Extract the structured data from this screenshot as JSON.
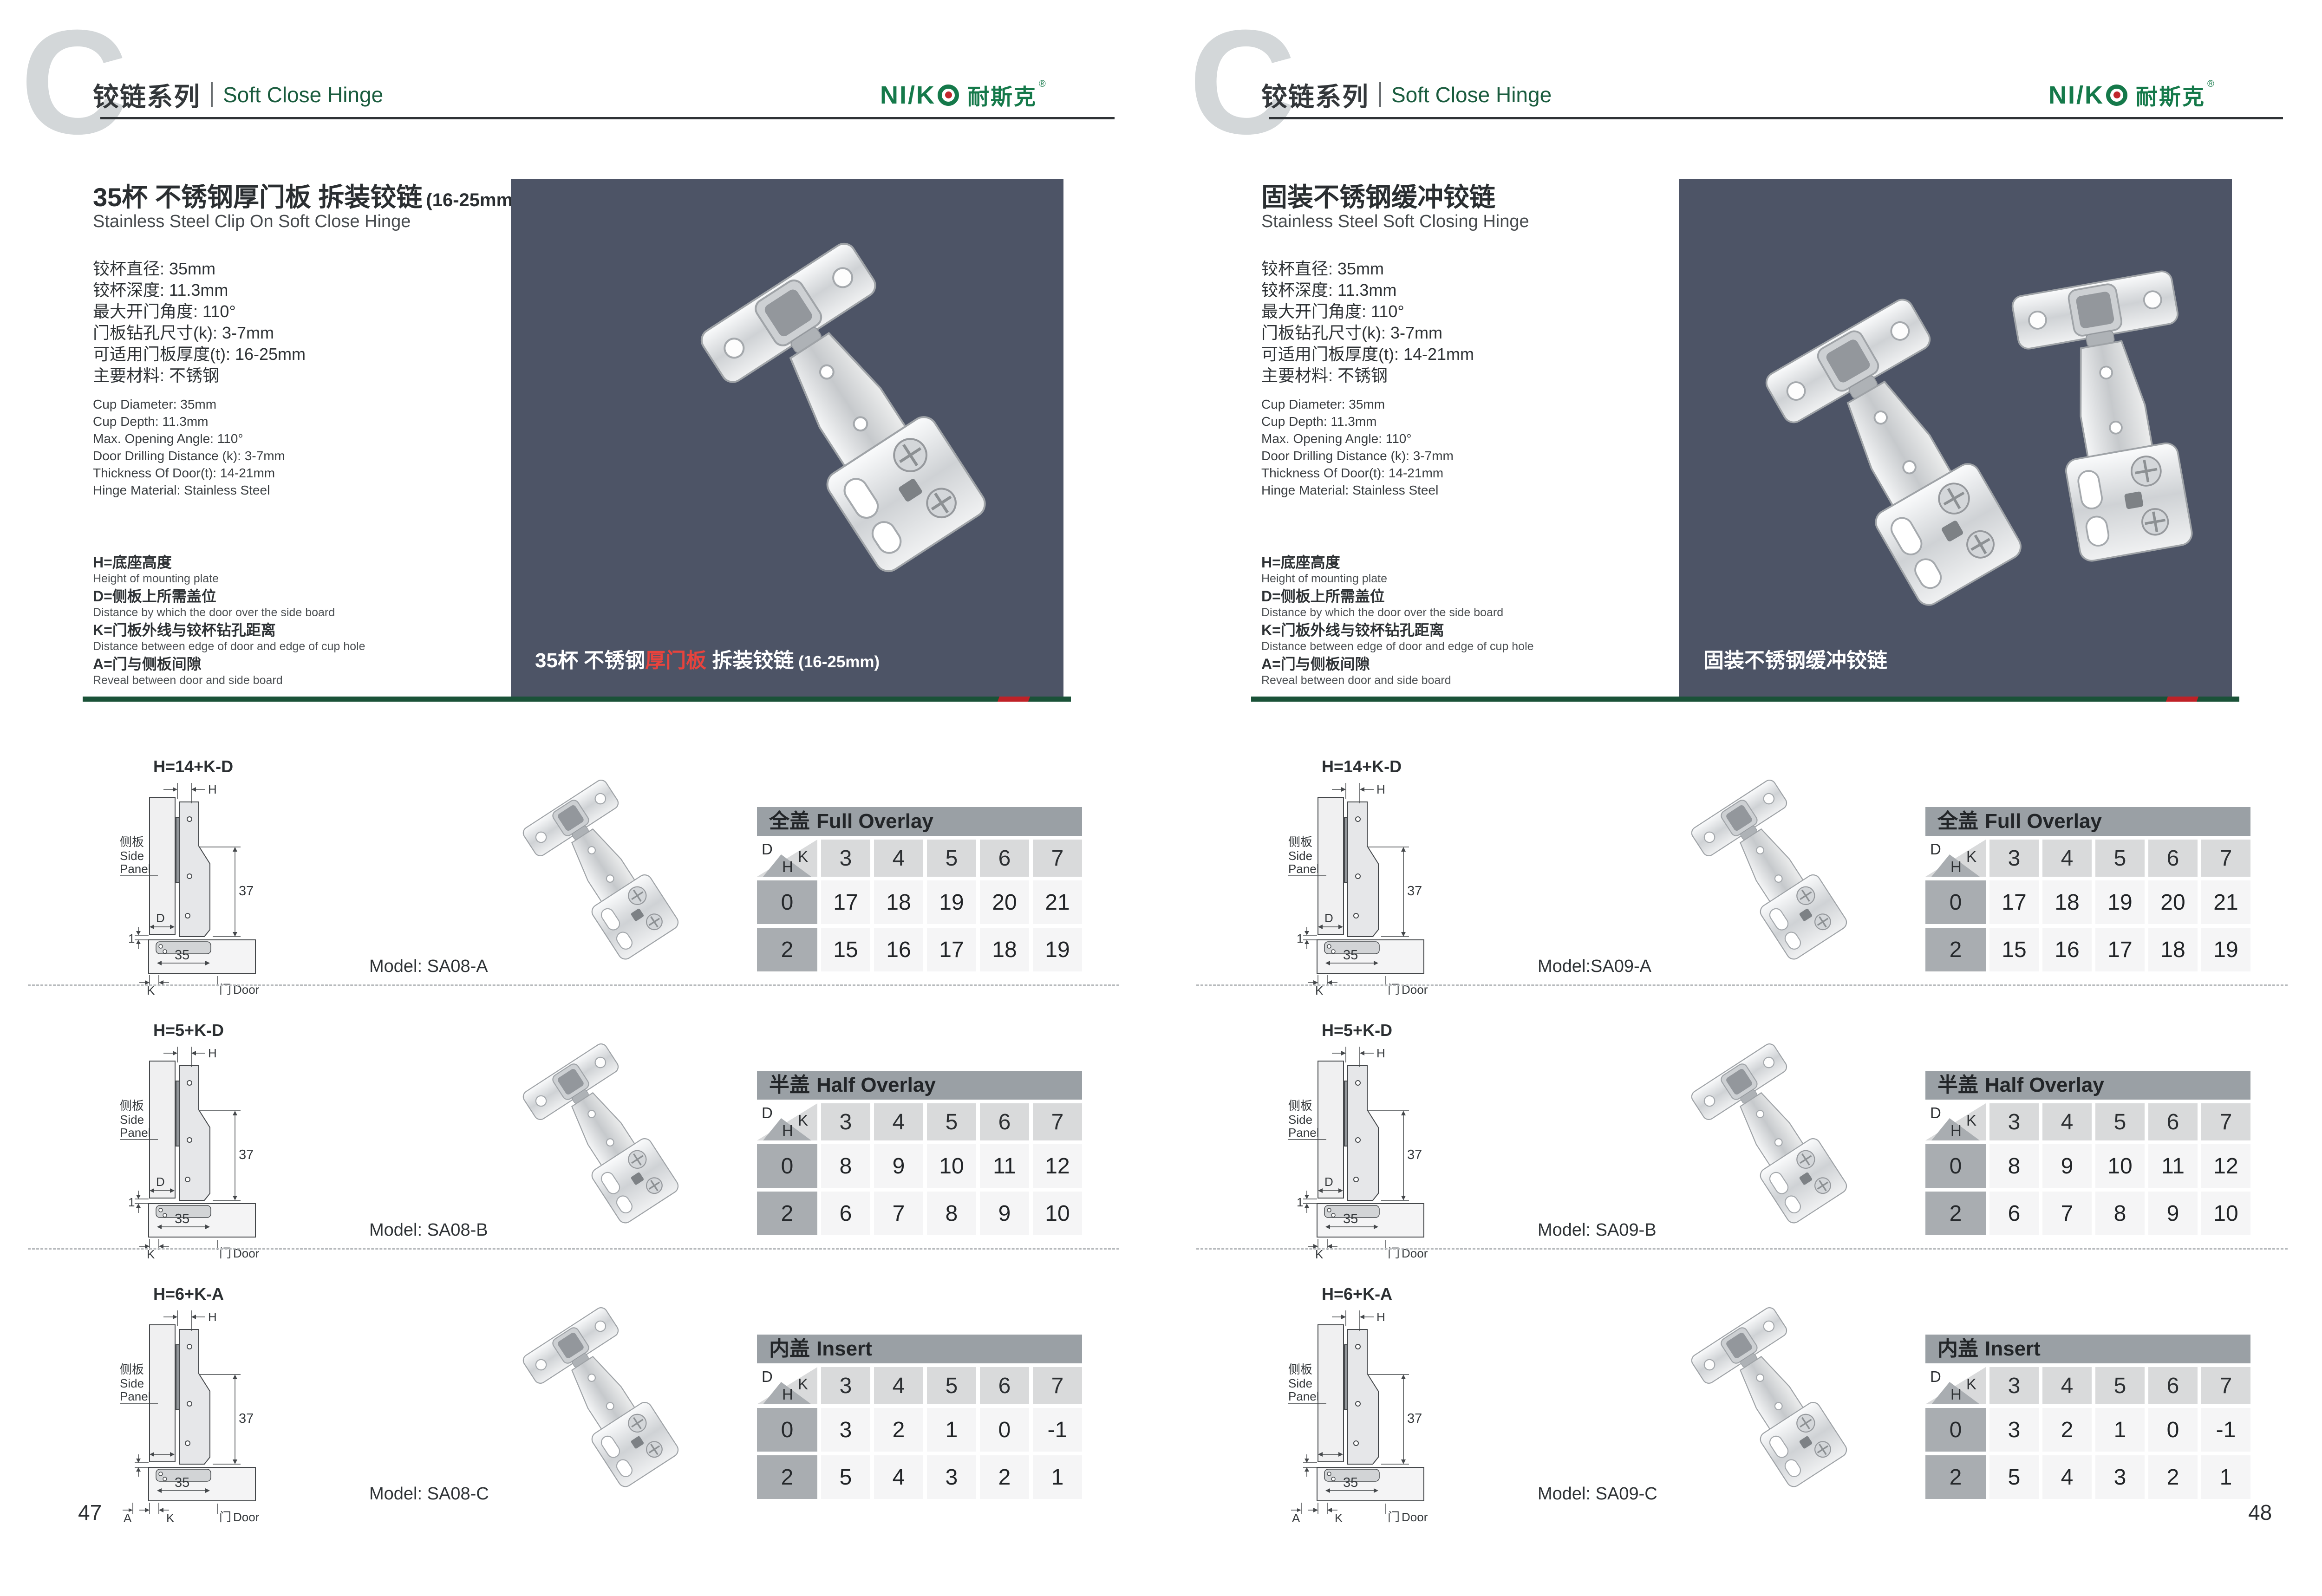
{
  "shared": {
    "header": {
      "watermark": "C",
      "series_cn": "铰链系列",
      "series_en": "Soft Close Hinge"
    },
    "logo": {
      "latin": "NI/K",
      "cn": "耐斯克",
      "reg": "®"
    },
    "corner": {
      "d": "D",
      "k": "K",
      "h": "H"
    },
    "diagram": {
      "h": "H",
      "d": "D",
      "k": "K",
      "a": "A",
      "gap": "1",
      "cup_width": "35",
      "plate_height": "37",
      "side_panel_cn": "侧板",
      "side_panel_en_1": "Side",
      "side_panel_en_2": "Panel",
      "door_cn": "门",
      "door_en": "Door"
    }
  },
  "colors": {
    "brand_green": "#15794a",
    "heading_green": "#1a5c3e",
    "accent_red": "#c1272d",
    "divider_green": "#1a5238",
    "divider_red": "#bf2127",
    "photo_background": "#4d5466",
    "table_title_bar": "#9aa0a5",
    "table_header_cell": "#d9dadb",
    "table_row_label": "#a9adb1",
    "table_value_cell": "#f5f5f6",
    "watermark_gray": "#d3d7d9",
    "caption_red": "#e8433d"
  },
  "pages": [
    {
      "page_number": "47",
      "product": {
        "title_cn": "35杯 不锈钢厚门板 拆装铰链",
        "title_suffix": "(16-25mm)",
        "subtitle_en": "Stainless Steel Clip On Soft Close Hinge",
        "specs_cn": [
          "铰杯直径: 35mm",
          "铰杯深度: 11.3mm",
          "最大开门角度: 110°",
          "门板钻孔尺寸(k): 3-7mm",
          "可适用门板厚度(t): 16-25mm",
          "主要材料: 不锈钢"
        ],
        "specs_en": [
          "Cup Diameter: 35mm",
          "Cup Depth: 11.3mm",
          "Max. Opening Angle: 110°",
          "Door Drilling Distance (k): 3-7mm",
          "Thickness Of Door(t): 14-21mm",
          "Hinge Material: Stainless Steel"
        ],
        "definitions": [
          {
            "cn": "H=底座高度",
            "en": "Height of mounting plate"
          },
          {
            "cn": "D=侧板上所需盖位",
            "en": "Distance by which the door over the side board"
          },
          {
            "cn": "K=门板外线与铰杯钻孔距离",
            "en": "Distance between edge of door and edge of cup hole"
          },
          {
            "cn": "A=门与侧板间隙",
            "en": "Reveal between door and side board"
          }
        ],
        "photo_caption": {
          "pre": "35杯 不锈钢",
          "red": "厚门板",
          "post": " 拆装铰链",
          "suffix": " (16-25mm)"
        }
      },
      "sections": [
        {
          "formula": "H=14+K-D",
          "model": "Model: SA08-A",
          "table": {
            "title_cn": "全盖",
            "title_en": "Full Overlay",
            "k_values": [
              "3",
              "4",
              "5",
              "6",
              "7"
            ],
            "rows": [
              {
                "h": "0",
                "values": [
                  "17",
                  "18",
                  "19",
                  "20",
                  "21"
                ]
              },
              {
                "h": "2",
                "values": [
                  "15",
                  "16",
                  "17",
                  "18",
                  "19"
                ]
              }
            ]
          }
        },
        {
          "formula": "H=5+K-D",
          "model": "Model: SA08-B",
          "table": {
            "title_cn": "半盖",
            "title_en": "Half Overlay",
            "k_values": [
              "3",
              "4",
              "5",
              "6",
              "7"
            ],
            "rows": [
              {
                "h": "0",
                "values": [
                  "8",
                  "9",
                  "10",
                  "11",
                  "12"
                ]
              },
              {
                "h": "2",
                "values": [
                  "6",
                  "7",
                  "8",
                  "9",
                  "10"
                ]
              }
            ]
          }
        },
        {
          "formula": "H=6+K-A",
          "model": "Model: SA08-C",
          "table": {
            "title_cn": "内盖",
            "title_en": "Insert",
            "k_values": [
              "3",
              "4",
              "5",
              "6",
              "7"
            ],
            "rows": [
              {
                "h": "0",
                "values": [
                  "3",
                  "2",
                  "1",
                  "0",
                  "-1"
                ]
              },
              {
                "h": "2",
                "values": [
                  "5",
                  "4",
                  "3",
                  "2",
                  "1"
                ]
              }
            ]
          }
        }
      ]
    },
    {
      "page_number": "48",
      "product": {
        "title_cn": "固装不锈钢缓冲铰链",
        "title_suffix": "",
        "subtitle_en": "Stainless Steel Soft Closing Hinge",
        "specs_cn": [
          "铰杯直径: 35mm",
          "铰杯深度: 11.3mm",
          "最大开门角度: 110°",
          "门板钻孔尺寸(k): 3-7mm",
          "可适用门板厚度(t): 14-21mm",
          "主要材料: 不锈钢"
        ],
        "specs_en": [
          "Cup Diameter: 35mm",
          "Cup Depth: 11.3mm",
          "Max. Opening Angle: 110°",
          "Door Drilling Distance (k): 3-7mm",
          "Thickness Of Door(t): 14-21mm",
          "Hinge Material: Stainless Steel"
        ],
        "definitions": [
          {
            "cn": "H=底座高度",
            "en": "Height of mounting plate"
          },
          {
            "cn": "D=侧板上所需盖位",
            "en": "Distance by which the door over the side board"
          },
          {
            "cn": "K=门板外线与铰杯钻孔距离",
            "en": "Distance between edge of door and edge of cup hole"
          },
          {
            "cn": "A=门与侧板间隙",
            "en": "Reveal between door and side board"
          }
        ],
        "photo_caption": {
          "pre": "固装不锈钢缓冲铰链",
          "red": "",
          "post": "",
          "suffix": ""
        }
      },
      "sections": [
        {
          "formula": "H=14+K-D",
          "model": "Model:SA09-A",
          "table": {
            "title_cn": "全盖",
            "title_en": "Full Overlay",
            "k_values": [
              "3",
              "4",
              "5",
              "6",
              "7"
            ],
            "rows": [
              {
                "h": "0",
                "values": [
                  "17",
                  "18",
                  "19",
                  "20",
                  "21"
                ]
              },
              {
                "h": "2",
                "values": [
                  "15",
                  "16",
                  "17",
                  "18",
                  "19"
                ]
              }
            ]
          }
        },
        {
          "formula": "H=5+K-D",
          "model": "Model: SA09-B",
          "table": {
            "title_cn": "半盖",
            "title_en": "Half Overlay",
            "k_values": [
              "3",
              "4",
              "5",
              "6",
              "7"
            ],
            "rows": [
              {
                "h": "0",
                "values": [
                  "8",
                  "9",
                  "10",
                  "11",
                  "12"
                ]
              },
              {
                "h": "2",
                "values": [
                  "6",
                  "7",
                  "8",
                  "9",
                  "10"
                ]
              }
            ]
          }
        },
        {
          "formula": "H=6+K-A",
          "model": "Model: SA09-C",
          "table": {
            "title_cn": "内盖",
            "title_en": "Insert",
            "k_values": [
              "3",
              "4",
              "5",
              "6",
              "7"
            ],
            "rows": [
              {
                "h": "0",
                "values": [
                  "3",
                  "2",
                  "1",
                  "0",
                  "-1"
                ]
              },
              {
                "h": "2",
                "values": [
                  "5",
                  "4",
                  "3",
                  "2",
                  "1"
                ]
              }
            ]
          }
        }
      ]
    }
  ]
}
